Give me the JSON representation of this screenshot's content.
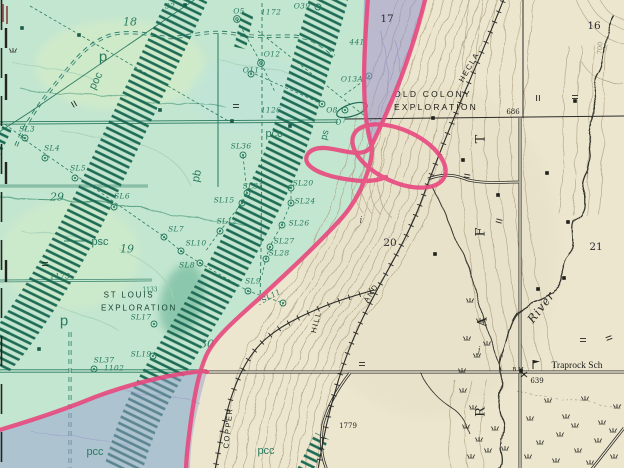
{
  "map": {
    "palette": {
      "paper": "#ece6cf",
      "green_overlay": "#c3e6d0",
      "purple_overlay": "#9598cd",
      "pink_annotation": "#e8487e",
      "map_green_ink": "#2a7a60",
      "dike_teal": "#1d6a55",
      "black_ink": "#23231f",
      "contour_tan": "#b3a78a"
    },
    "labels": [
      {
        "id": "unit-p-north",
        "text": "p",
        "x": 103,
        "y": 57,
        "rot": 0,
        "cls": "unitlg"
      },
      {
        "id": "unit-p-south",
        "text": "p",
        "x": 64,
        "y": 321,
        "rot": 0,
        "cls": "unitlg"
      },
      {
        "id": "unit-poc",
        "text": "poc",
        "x": 96,
        "y": 81,
        "rot": -64,
        "cls": "unit"
      },
      {
        "id": "unit-pcc-1",
        "text": "pcc",
        "x": 274,
        "y": 134,
        "rot": 0,
        "cls": "unit"
      },
      {
        "id": "unit-pcc-2",
        "text": "pcc",
        "x": 95,
        "y": 452,
        "rot": 0,
        "cls": "unit"
      },
      {
        "id": "unit-pcc-3",
        "text": "pcc",
        "x": 266,
        "y": 451,
        "rot": 0,
        "cls": "unit"
      },
      {
        "id": "unit-psc",
        "text": "psc",
        "x": 100,
        "y": 242,
        "rot": 0,
        "cls": "unit"
      },
      {
        "id": "unit-pb",
        "text": "pb",
        "x": 197,
        "y": 176,
        "rot": -78,
        "cls": "unit"
      },
      {
        "id": "unit-ps",
        "text": "ps",
        "x": 325,
        "y": 135,
        "rot": -75,
        "cls": "unitsm"
      },
      {
        "id": "hole-sl3",
        "text": "SL3",
        "x": 27,
        "y": 129,
        "rot": 0,
        "cls": "sl"
      },
      {
        "id": "hole-sl4",
        "text": "SL4",
        "x": 52,
        "y": 148,
        "rot": 0,
        "cls": "sl"
      },
      {
        "id": "hole-sl5",
        "text": "SL5",
        "x": 78,
        "y": 168,
        "rot": 0,
        "cls": "sl"
      },
      {
        "id": "hole-sl6",
        "text": "SL6",
        "x": 122,
        "y": 196,
        "rot": 0,
        "cls": "sl"
      },
      {
        "id": "hole-sl7",
        "text": "SL7",
        "x": 176,
        "y": 229,
        "rot": 0,
        "cls": "sl"
      },
      {
        "id": "hole-sl8",
        "text": "SL8",
        "x": 187,
        "y": 265,
        "rot": 0,
        "cls": "sl"
      },
      {
        "id": "hole-sl9",
        "text": "SL9",
        "x": 253,
        "y": 281,
        "rot": 0,
        "cls": "sl"
      },
      {
        "id": "hole-sl10",
        "text": "SL10",
        "x": 196,
        "y": 243,
        "rot": 0,
        "cls": "sl"
      },
      {
        "id": "hole-sl11",
        "text": "SL11",
        "x": 271,
        "y": 296,
        "rot": -28,
        "cls": "sl"
      },
      {
        "id": "hole-sl12",
        "text": "SL12",
        "x": 227,
        "y": 221,
        "rot": 0,
        "cls": "sl"
      },
      {
        "id": "hole-sl15",
        "text": "SL15",
        "x": 224,
        "y": 200,
        "rot": 0,
        "cls": "sl"
      },
      {
        "id": "hole-sl17",
        "text": "SL17",
        "x": 141,
        "y": 317,
        "rot": 0,
        "cls": "sl"
      },
      {
        "id": "hole-sl19",
        "text": "SL19",
        "x": 141,
        "y": 354,
        "rot": 0,
        "cls": "sl"
      },
      {
        "id": "hole-sl20",
        "text": "SL20",
        "x": 303,
        "y": 183,
        "rot": 0,
        "cls": "sl"
      },
      {
        "id": "hole-sl24",
        "text": "SL24",
        "x": 305,
        "y": 201,
        "rot": 0,
        "cls": "sl"
      },
      {
        "id": "hole-sl26",
        "text": "SL26",
        "x": 299,
        "y": 223,
        "rot": 0,
        "cls": "sl"
      },
      {
        "id": "hole-sl27",
        "text": "SL27",
        "x": 284,
        "y": 241,
        "rot": 0,
        "cls": "sl"
      },
      {
        "id": "hole-sl28",
        "text": "SL28",
        "x": 279,
        "y": 253,
        "rot": 0,
        "cls": "sl"
      },
      {
        "id": "hole-sl31",
        "text": "SL31",
        "x": 253,
        "y": 186,
        "rot": 0,
        "cls": "sl"
      },
      {
        "id": "hole-sl36",
        "text": "SL36",
        "x": 241,
        "y": 146,
        "rot": 0,
        "cls": "sl"
      },
      {
        "id": "hole-sl37",
        "text": "SL37",
        "x": 104,
        "y": 360,
        "rot": 0,
        "cls": "sl"
      },
      {
        "id": "hole-o5",
        "text": "O5",
        "x": 239,
        "y": 11,
        "rot": 0,
        "cls": "sl"
      },
      {
        "id": "hole-o39",
        "text": "O39",
        "x": 302,
        "y": 6,
        "rot": 0,
        "cls": "sl"
      },
      {
        "id": "hole-o12",
        "text": "O12",
        "x": 272,
        "y": 54,
        "rot": 0,
        "cls": "sl"
      },
      {
        "id": "hole-o11",
        "text": "O11",
        "x": 251,
        "y": 70,
        "rot": 0,
        "cls": "sl"
      },
      {
        "id": "hole-o13a",
        "text": "O13A",
        "x": 352,
        "y": 79,
        "rot": 0,
        "cls": "sl"
      },
      {
        "id": "hole-o8",
        "text": "O8",
        "x": 332,
        "y": 110,
        "rot": 0,
        "cls": "sl"
      },
      {
        "id": "hole-o7",
        "text": "O7",
        "x": 341,
        "y": 121,
        "rot": -20,
        "cls": "sl"
      },
      {
        "id": "num-1172",
        "text": "1172",
        "x": 271,
        "y": 12,
        "rot": 0,
        "cls": "sl"
      },
      {
        "id": "num-1126",
        "text": "1126",
        "x": 271,
        "y": 110,
        "rot": 0,
        "cls": "sl"
      },
      {
        "id": "num-1173",
        "text": "1173",
        "x": 60,
        "y": 276,
        "rot": 0,
        "cls": "sl"
      },
      {
        "id": "num-1102",
        "text": "1102",
        "x": 114,
        "y": 368,
        "rot": 0,
        "cls": "sl"
      },
      {
        "id": "num-441",
        "text": "441",
        "x": 357,
        "y": 42,
        "rot": 0,
        "cls": "sl"
      },
      {
        "id": "num-32",
        "text": "32",
        "x": 170,
        "y": 6,
        "rot": 0,
        "cls": "sl"
      },
      {
        "id": "section-18",
        "text": "18",
        "x": 130,
        "y": 22,
        "rot": 0,
        "cls": "secg"
      },
      {
        "id": "section-29",
        "text": "29",
        "x": 57,
        "y": 197,
        "rot": 0,
        "cls": "secg"
      },
      {
        "id": "section-19",
        "text": "19",
        "x": 127,
        "y": 249,
        "rot": 0,
        "cls": "secg"
      },
      {
        "id": "section-30",
        "text": "30",
        "x": 207,
        "y": 344,
        "rot": 0,
        "cls": "secg"
      },
      {
        "id": "section-17",
        "text": "17",
        "x": 387,
        "y": 19,
        "rot": 0,
        "cls": "seck"
      },
      {
        "id": "section-16",
        "text": "16",
        "x": 594,
        "y": 26,
        "rot": 0,
        "cls": "seck"
      },
      {
        "id": "section-20",
        "text": "20",
        "x": 390,
        "y": 243,
        "rot": 0,
        "cls": "seck"
      },
      {
        "id": "section-21",
        "text": "21",
        "x": 596,
        "y": 247,
        "rot": 0,
        "cls": "seck"
      },
      {
        "id": "elev-686",
        "text": "686",
        "x": 513,
        "y": 112,
        "rot": 0,
        "cls": "elev"
      },
      {
        "id": "elev-639",
        "text": "639",
        "x": 537,
        "y": 381,
        "rot": 0,
        "cls": "elev"
      },
      {
        "id": "elev-1779",
        "text": "1779",
        "x": 348,
        "y": 426,
        "rot": 0,
        "cls": "elev"
      },
      {
        "id": "contour-700",
        "text": "700",
        "x": 600,
        "y": 48,
        "rot": -85,
        "cls": "elevg"
      },
      {
        "id": "mine-old-colony-1",
        "text": "OLD COLONY",
        "x": 433,
        "y": 94,
        "rot": 0,
        "cls": "mine"
      },
      {
        "id": "mine-old-colony-2",
        "text": "EXPLORATION",
        "x": 436,
        "y": 107,
        "rot": 0,
        "cls": "mine"
      },
      {
        "id": "mine-st-louis-1",
        "text": "ST LOUIS",
        "x": 129,
        "y": 295,
        "rot": 0,
        "cls": "mineg"
      },
      {
        "id": "mine-st-louis-2",
        "text": "EXPLORATION",
        "x": 139,
        "y": 308,
        "rot": 0,
        "cls": "mineg"
      },
      {
        "id": "num-1133",
        "text": "1133",
        "x": 150,
        "y": 290,
        "rot": 0,
        "cls": "tinyg"
      },
      {
        "id": "route-hecla",
        "text": "HECLA",
        "x": 469,
        "y": 67,
        "rot": -60,
        "cls": "route"
      },
      {
        "id": "route-and",
        "text": "AND",
        "x": 371,
        "y": 293,
        "rot": -57,
        "cls": "route"
      },
      {
        "id": "route-hill",
        "text": "HILL",
        "x": 316,
        "y": 322,
        "rot": -76,
        "cls": "route"
      },
      {
        "id": "route-copper",
        "text": "COPPER",
        "x": 228,
        "y": 428,
        "rot": -84,
        "cls": "route"
      },
      {
        "id": "riverletter-t",
        "text": "T",
        "x": 481,
        "y": 139,
        "rot": -90,
        "cls": "rl"
      },
      {
        "id": "riverletter-f",
        "text": "F",
        "x": 481,
        "y": 232,
        "rot": -90,
        "cls": "rl"
      },
      {
        "id": "riverletter-a",
        "text": "A",
        "x": 483,
        "y": 322,
        "rot": -90,
        "cls": "rl"
      },
      {
        "id": "riverletter-r",
        "text": "R",
        "x": 481,
        "y": 412,
        "rot": -90,
        "cls": "rl"
      },
      {
        "id": "river-name",
        "text": "River",
        "x": 541,
        "y": 307,
        "rot": -52,
        "cls": "river"
      },
      {
        "id": "place-traprock-sch",
        "text": "Traprock Sch",
        "x": 577,
        "y": 366,
        "rot": 0,
        "cls": "place"
      },
      {
        "id": "benchmark-bm",
        "text": "B M",
        "x": 518,
        "y": 370,
        "rot": 0,
        "cls": "tinyk"
      },
      {
        "id": "letter-j",
        "text": "j",
        "x": 479,
        "y": 351,
        "rot": 0,
        "cls": "ij"
      },
      {
        "id": "letter-i",
        "text": "i",
        "x": 361,
        "y": 221,
        "rot": 0,
        "cls": "ij"
      }
    ]
  }
}
